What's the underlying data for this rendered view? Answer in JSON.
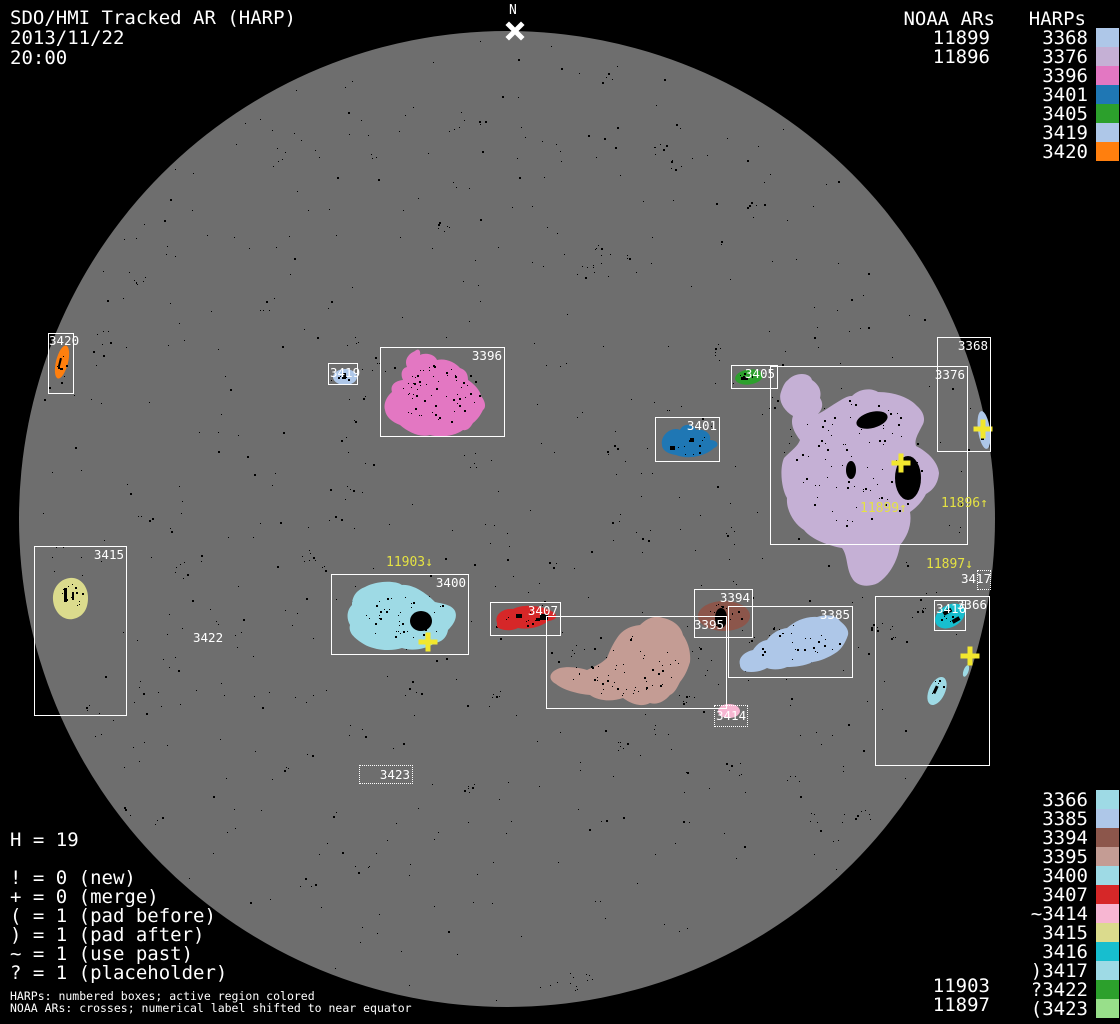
{
  "header": {
    "title": "SDO/HMI Tracked AR (HARP)",
    "date": "2013/11/22",
    "time": "20:00"
  },
  "compass": {
    "north_label": "N"
  },
  "legend_top": {
    "noaa_title": "NOAA ARs",
    "harps_title": "HARPs",
    "noaa": [
      "11899",
      "11896"
    ],
    "harps": [
      "3368",
      "3376",
      "3396",
      "3401",
      "3405",
      "3419",
      "3420"
    ]
  },
  "legend_bottom": {
    "harps": [
      "3366",
      "3385",
      "3394",
      "3395",
      "3400",
      "3407",
      "~3414",
      "3415",
      "3416",
      ")3417",
      "?3422",
      "(3423"
    ],
    "colors": [
      "#9edae5",
      "#aec7e8",
      "#8c564b",
      "#c49c94",
      "#9edae5",
      "#d62728",
      "#f7b6d2",
      "#dbdb8d",
      "#17becf",
      "#9edae5",
      "#2ca02c",
      "#98df8a"
    ],
    "noaa": [
      "11903",
      "11897"
    ]
  },
  "stats": {
    "h_line": "H = 19"
  },
  "flag_legend": [
    "! = 0 (new)",
    "+ = 0 (merge)",
    "( = 1 (pad before)",
    ") = 1 (pad after)",
    "~ = 1 (use past)",
    "? = 1 (placeholder)"
  ],
  "footer": [
    "HARPs: numbered boxes; active region colored",
    "NOAA ARs: crosses; numerical label shifted to near equator"
  ],
  "boxes": {
    "3420": "3420",
    "3419": "3419",
    "3396": "3396",
    "3405": "3405",
    "3376": "3376",
    "3368": "3368",
    "3401": "3401",
    "3415": "3415",
    "3400": "3400",
    "3407": "3407",
    "3394": "3394",
    "3395": "3395",
    "3385": "3385",
    "3366": "3366",
    "3416": "3416",
    "3414": "3414",
    "3423": "3423",
    "3417": "3417",
    "3422": "3422"
  },
  "noaa_marks": {
    "11899": "11899↑",
    "11896": "11896↑",
    "11903": "11903↓",
    "11897": "11897↓"
  },
  "palette": {
    "3366": "#9edae5",
    "3368": "#aec7e8",
    "3376": "#c5b0d5",
    "3385": "#aec7e8",
    "3394": "#8c564b",
    "3395": "#c49c94",
    "3396": "#e377c2",
    "3400": "#9edae5",
    "3401": "#1f77b4",
    "3405": "#2ca02c",
    "3407": "#d62728",
    "3414": "#f7b6d2",
    "3415": "#dbdb8d",
    "3416": "#17becf",
    "3417": "#9edae5",
    "3419": "#aec7e8",
    "3420": "#ff7f0e",
    "3422": "#2ca02c",
    "3423": "#98df8a"
  },
  "colors": {
    "background": "#000000",
    "disk": "#6e6e6e",
    "box_border": "#ffffff",
    "text": "#ffffff",
    "noaa_yellow": "#e5e243",
    "cross_yellow": "#f2e72e"
  },
  "chart_data": {
    "type": "scatter",
    "title": "SDO/HMI Tracked AR (HARP) full-disk map, 2013/11/22 20:00",
    "harp_regions": [
      {
        "harp": "3368",
        "color": "#aec7e8",
        "box_px": [
          937,
          337,
          54,
          115
        ],
        "style": "solid"
      },
      {
        "harp": "3376",
        "color": "#c5b0d5",
        "box_px": [
          770,
          366,
          198,
          179
        ],
        "style": "solid"
      },
      {
        "harp": "3396",
        "color": "#e377c2",
        "box_px": [
          380,
          347,
          125,
          90
        ],
        "style": "solid"
      },
      {
        "harp": "3401",
        "color": "#1f77b4",
        "box_px": [
          655,
          417,
          65,
          45
        ],
        "style": "solid"
      },
      {
        "harp": "3405",
        "color": "#2ca02c",
        "box_px": [
          731,
          365,
          47,
          24
        ],
        "style": "solid"
      },
      {
        "harp": "3419",
        "color": "#aec7e8",
        "box_px": [
          328,
          363,
          30,
          22
        ],
        "style": "solid"
      },
      {
        "harp": "3420",
        "color": "#ff7f0e",
        "box_px": [
          48,
          333,
          26,
          61
        ],
        "style": "solid"
      },
      {
        "harp": "3366",
        "color": "#9edae5",
        "box_px": [
          875,
          596,
          115,
          170
        ],
        "style": "solid"
      },
      {
        "harp": "3385",
        "color": "#aec7e8",
        "box_px": [
          728,
          606,
          125,
          72
        ],
        "style": "solid"
      },
      {
        "harp": "3394",
        "color": "#8c564b",
        "box_px": [
          694,
          589,
          59,
          49
        ],
        "style": "solid"
      },
      {
        "harp": "3395",
        "color": "#c49c94",
        "box_px": [
          546,
          616,
          181,
          93
        ],
        "style": "solid"
      },
      {
        "harp": "3400",
        "color": "#9edae5",
        "box_px": [
          331,
          574,
          138,
          81
        ],
        "style": "solid"
      },
      {
        "harp": "3407",
        "color": "#d62728",
        "box_px": [
          490,
          602,
          71,
          34
        ],
        "style": "solid"
      },
      {
        "harp": "3414",
        "color": "#f7b6d2",
        "box_px": [
          714,
          705,
          34,
          22
        ],
        "style": "dotted",
        "flag": "~"
      },
      {
        "harp": "3415",
        "color": "#dbdb8d",
        "box_px": [
          34,
          546,
          93,
          170
        ],
        "style": "solid"
      },
      {
        "harp": "3416",
        "color": "#17becf",
        "box_px": [
          934,
          600,
          32,
          31
        ],
        "style": "solid"
      },
      {
        "harp": "3417",
        "color": "#9edae5",
        "box_px": [
          977,
          570,
          14,
          20
        ],
        "style": "dotted",
        "flag": ")"
      },
      {
        "harp": "3422",
        "color": "#2ca02c",
        "label_px": [
          193,
          631
        ],
        "style": "label-only",
        "flag": "?"
      },
      {
        "harp": "3423",
        "color": "#98df8a",
        "box_px": [
          359,
          765,
          54,
          19
        ],
        "style": "dotted",
        "flag": "("
      }
    ],
    "noaa_ars": [
      {
        "noaa": "11899",
        "cross_px": [
          901,
          463
        ],
        "label_px": [
          860,
          502
        ],
        "arrow": "up"
      },
      {
        "noaa": "11896",
        "cross_px": [
          983,
          429
        ],
        "label_px": [
          941,
          497
        ],
        "arrow": "up"
      },
      {
        "noaa": "11903",
        "cross_px": [
          428,
          642
        ],
        "label_px": [
          386,
          556
        ],
        "arrow": "down"
      },
      {
        "noaa": "11897",
        "cross_px": [
          970,
          656
        ],
        "label_px": [
          926,
          558
        ],
        "arrow": "down"
      }
    ],
    "disk_px": {
      "cx": 507,
      "cy": 519,
      "r": 488
    },
    "h_count": 19
  }
}
